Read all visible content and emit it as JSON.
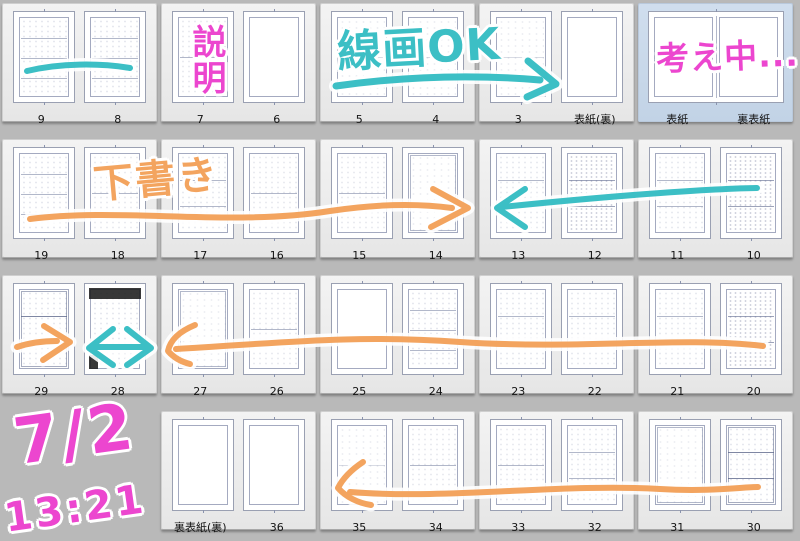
{
  "colors": {
    "background": "#b9b9b9",
    "cell_background": "#ececec",
    "selected_cell_background": "#c8d8e9",
    "pink": "#ec46cf",
    "cyan": "#3cbfc5",
    "orange": "#f3a45f",
    "page_label_color": "#141414"
  },
  "rows": [
    {
      "units": [
        {
          "kind": "pair",
          "selected": false,
          "pages": [
            {
              "label": "9",
              "sketch": "rows4"
            },
            {
              "label": "8",
              "sketch": "rows4"
            }
          ]
        },
        {
          "kind": "pair",
          "selected": false,
          "pages": [
            {
              "label": "7",
              "sketch": "rows2"
            },
            {
              "label": "6",
              "sketch": "blank"
            }
          ]
        },
        {
          "kind": "pair",
          "selected": false,
          "pages": [
            {
              "label": "5",
              "sketch": "light"
            },
            {
              "label": "4",
              "sketch": "light"
            }
          ]
        },
        {
          "kind": "pair",
          "selected": false,
          "pages": [
            {
              "label": "3",
              "sketch": "light"
            },
            {
              "label": "表紙(裏)",
              "sketch": "blank"
            }
          ]
        },
        {
          "kind": "spread",
          "selected": true,
          "pages": [
            {
              "label": "表紙",
              "sketch": "blank"
            },
            {
              "label": "裏表紙",
              "sketch": "blank"
            }
          ]
        }
      ]
    },
    {
      "units": [
        {
          "kind": "pair",
          "selected": false,
          "pages": [
            {
              "label": "19",
              "sketch": "rows4"
            },
            {
              "label": "18",
              "sketch": "rows2"
            }
          ]
        },
        {
          "kind": "pair",
          "selected": false,
          "pages": [
            {
              "label": "17",
              "sketch": "rows3"
            },
            {
              "label": "16",
              "sketch": "rows2"
            }
          ]
        },
        {
          "kind": "pair",
          "selected": false,
          "pages": [
            {
              "label": "15",
              "sketch": "rows2"
            },
            {
              "label": "14",
              "sketch": "single"
            }
          ]
        },
        {
          "kind": "pair",
          "selected": false,
          "pages": [
            {
              "label": "13",
              "sketch": "rows3"
            },
            {
              "label": "12",
              "sketch": "dense"
            }
          ]
        },
        {
          "kind": "pair",
          "selected": false,
          "pages": [
            {
              "label": "11",
              "sketch": "rows3"
            },
            {
              "label": "10",
              "sketch": "dense"
            }
          ]
        }
      ]
    },
    {
      "units": [
        {
          "kind": "pair",
          "selected": false,
          "pages": [
            {
              "label": "29",
              "sketch": "rows3strong"
            },
            {
              "label": "28",
              "sketch": "dark"
            }
          ]
        },
        {
          "kind": "pair",
          "selected": false,
          "pages": [
            {
              "label": "27",
              "sketch": "single"
            },
            {
              "label": "26",
              "sketch": "rows2"
            }
          ]
        },
        {
          "kind": "pair",
          "selected": false,
          "pages": [
            {
              "label": "25",
              "sketch": "blank"
            },
            {
              "label": "24",
              "sketch": "rows4"
            }
          ]
        },
        {
          "kind": "pair",
          "selected": false,
          "pages": [
            {
              "label": "23",
              "sketch": "rows3"
            },
            {
              "label": "22",
              "sketch": "rows3"
            }
          ]
        },
        {
          "kind": "pair",
          "selected": false,
          "pages": [
            {
              "label": "21",
              "sketch": "rows3"
            },
            {
              "label": "20",
              "sketch": "dense"
            }
          ]
        }
      ]
    },
    {
      "units": [
        {
          "kind": "empty",
          "selected": false,
          "pages": []
        },
        {
          "kind": "pair",
          "selected": false,
          "pages": [
            {
              "label": "裏表紙(裏)",
              "sketch": "blank"
            },
            {
              "label": "36",
              "sketch": "blank"
            }
          ]
        },
        {
          "kind": "pair",
          "selected": false,
          "pages": [
            {
              "label": "35",
              "sketch": "light"
            },
            {
              "label": "34",
              "sketch": "rows2"
            }
          ]
        },
        {
          "kind": "pair",
          "selected": false,
          "pages": [
            {
              "label": "33",
              "sketch": "rows2"
            },
            {
              "label": "32",
              "sketch": "rows3"
            }
          ]
        },
        {
          "kind": "pair",
          "selected": false,
          "pages": [
            {
              "label": "31",
              "sketch": "single"
            },
            {
              "label": "30",
              "sketch": "rows3strong"
            }
          ]
        }
      ]
    }
  ],
  "annotations": {
    "notes": [
      {
        "id": "setsumei",
        "text": "説明",
        "color": "pink"
      },
      {
        "id": "senga-ok",
        "text": "線画OK",
        "color": "cyan"
      },
      {
        "id": "kangaechuu",
        "text": "考え中...",
        "color": "pink"
      },
      {
        "id": "shitagaki",
        "text": "下書き",
        "color": "orange"
      },
      {
        "id": "date",
        "text": "7/2",
        "color": "pink"
      },
      {
        "id": "time",
        "text": "13:21",
        "color": "pink"
      }
    ],
    "arrows": [
      {
        "id": "row1-swoosh",
        "color": "cyan",
        "shape": "stroke"
      },
      {
        "id": "row1-underline",
        "color": "cyan",
        "shape": "arrow-right"
      },
      {
        "id": "row2-long-right",
        "color": "orange",
        "shape": "arrow-right"
      },
      {
        "id": "row2-left",
        "color": "cyan",
        "shape": "arrow-left"
      },
      {
        "id": "row3-right-29",
        "color": "orange",
        "shape": "arrow-right"
      },
      {
        "id": "row3-double-28",
        "color": "cyan",
        "shape": "arrow-double"
      },
      {
        "id": "row3-long-left",
        "color": "orange",
        "shape": "arrow-left"
      },
      {
        "id": "row4-long-left",
        "color": "orange",
        "shape": "arrow-left"
      }
    ]
  }
}
